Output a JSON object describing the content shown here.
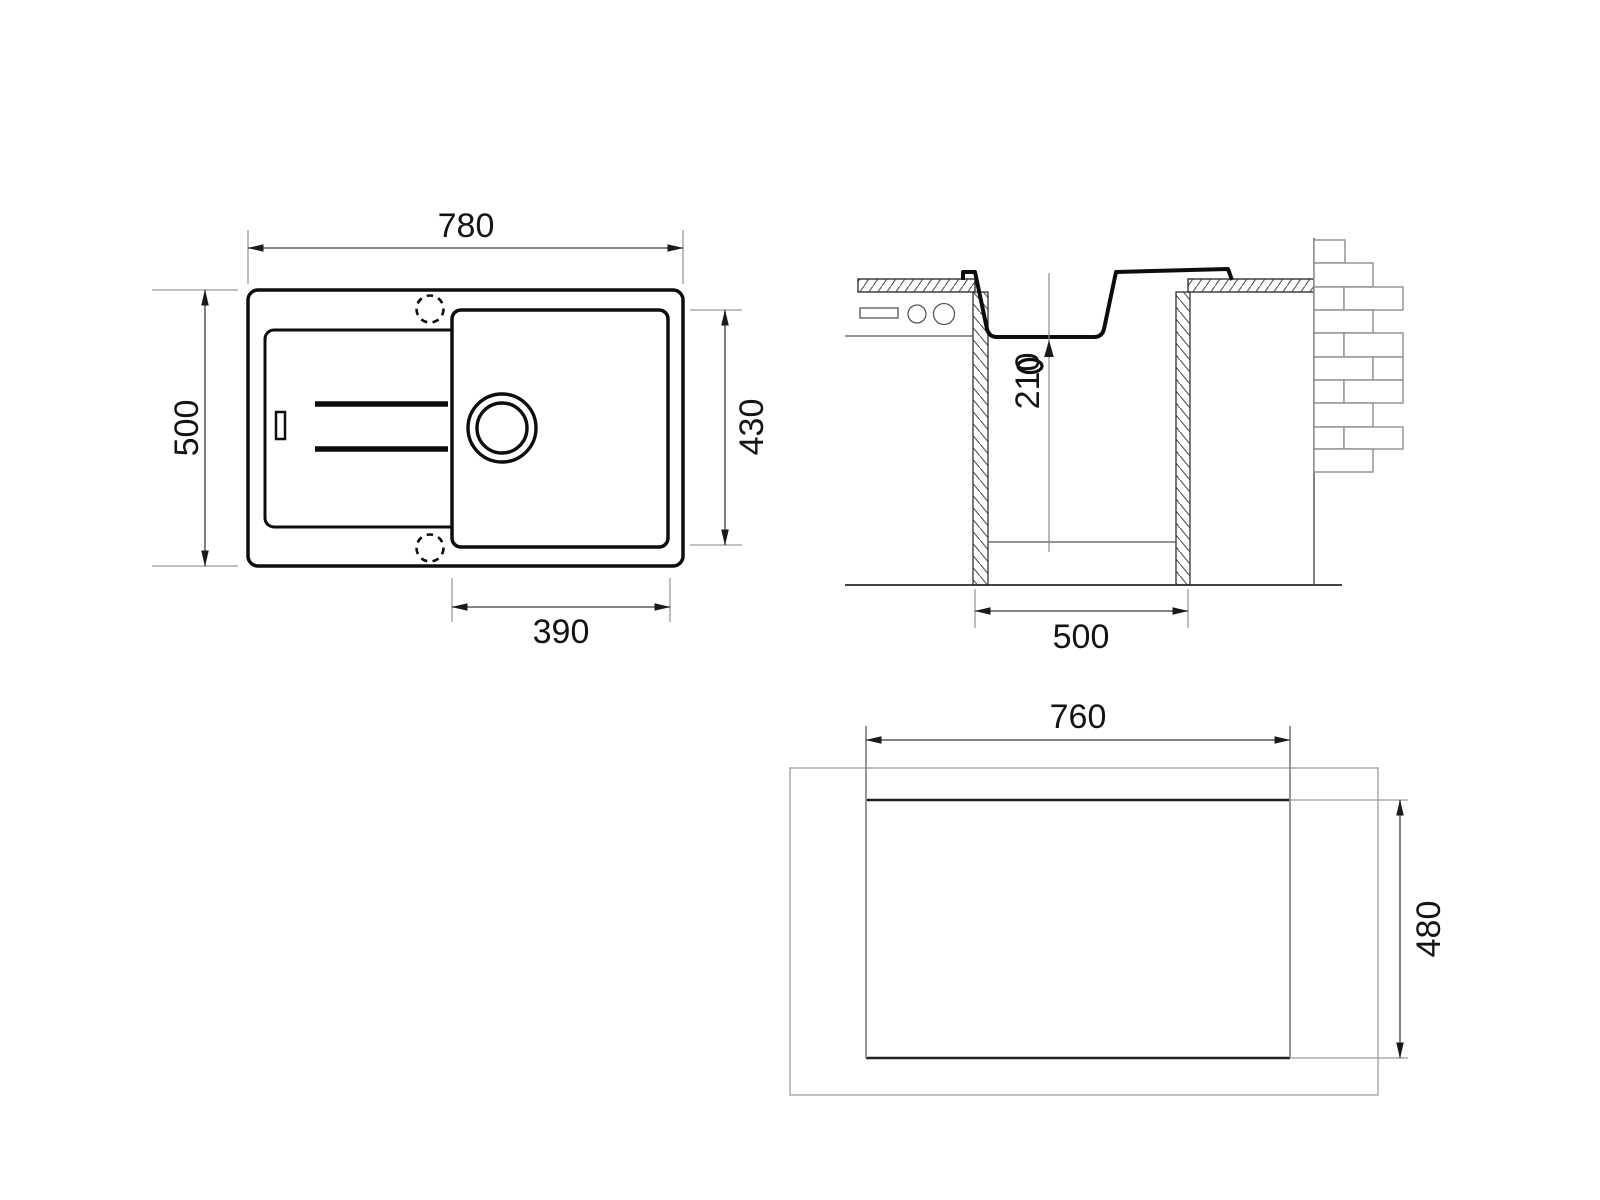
{
  "views": {
    "plan": {
      "dim_width": "780",
      "dim_height": "500",
      "dim_bowl_height": "430",
      "dim_bowl_width": "390"
    },
    "section": {
      "dim_bowl_depth": "210",
      "dim_cabinet_width": "500"
    },
    "cutout": {
      "dim_width": "760",
      "dim_height": "480"
    }
  },
  "colors": {
    "outline": "#0d0d0d",
    "dimension_line": "#3a3a3a",
    "extension_line": "#9a9a9a",
    "light_outline": "#aaaaaa",
    "background": "#ffffff"
  }
}
